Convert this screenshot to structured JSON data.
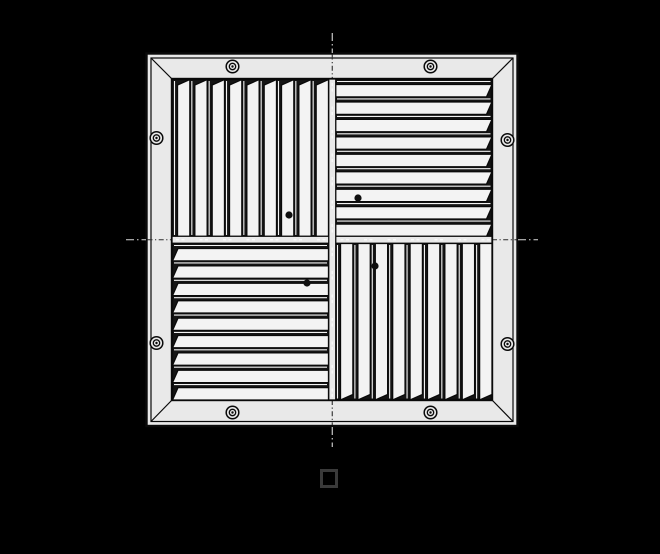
{
  "palette": {
    "background": "#000000",
    "frame": "#e9e9e9",
    "vane": "#f3f3f3",
    "line": "#0a0a0a",
    "gap": "#151515",
    "centerline_light": "#d9d9d9",
    "centerline_dark": "#2c2c2c",
    "glyph_box": "#3a3a3a"
  },
  "drawing": {
    "subject": "four-way-square-ceiling-diffuser-top-view",
    "screw_count": 8,
    "rivet_dot_count": 4,
    "quadrants": [
      {
        "id": "top-left",
        "vane_orientation": "vertical",
        "vane_count": 9,
        "taper_edge": "top"
      },
      {
        "id": "top-right",
        "vane_orientation": "horizontal",
        "vane_count": 9,
        "taper_edge": "right"
      },
      {
        "id": "bottom-left",
        "vane_orientation": "horizontal",
        "vane_count": 9,
        "taper_edge": "left"
      },
      {
        "id": "bottom-right",
        "vane_orientation": "vertical",
        "vane_count": 9,
        "taper_edge": "bottom"
      }
    ]
  },
  "footer": {
    "glyph_name": "missing-glyph-square"
  }
}
